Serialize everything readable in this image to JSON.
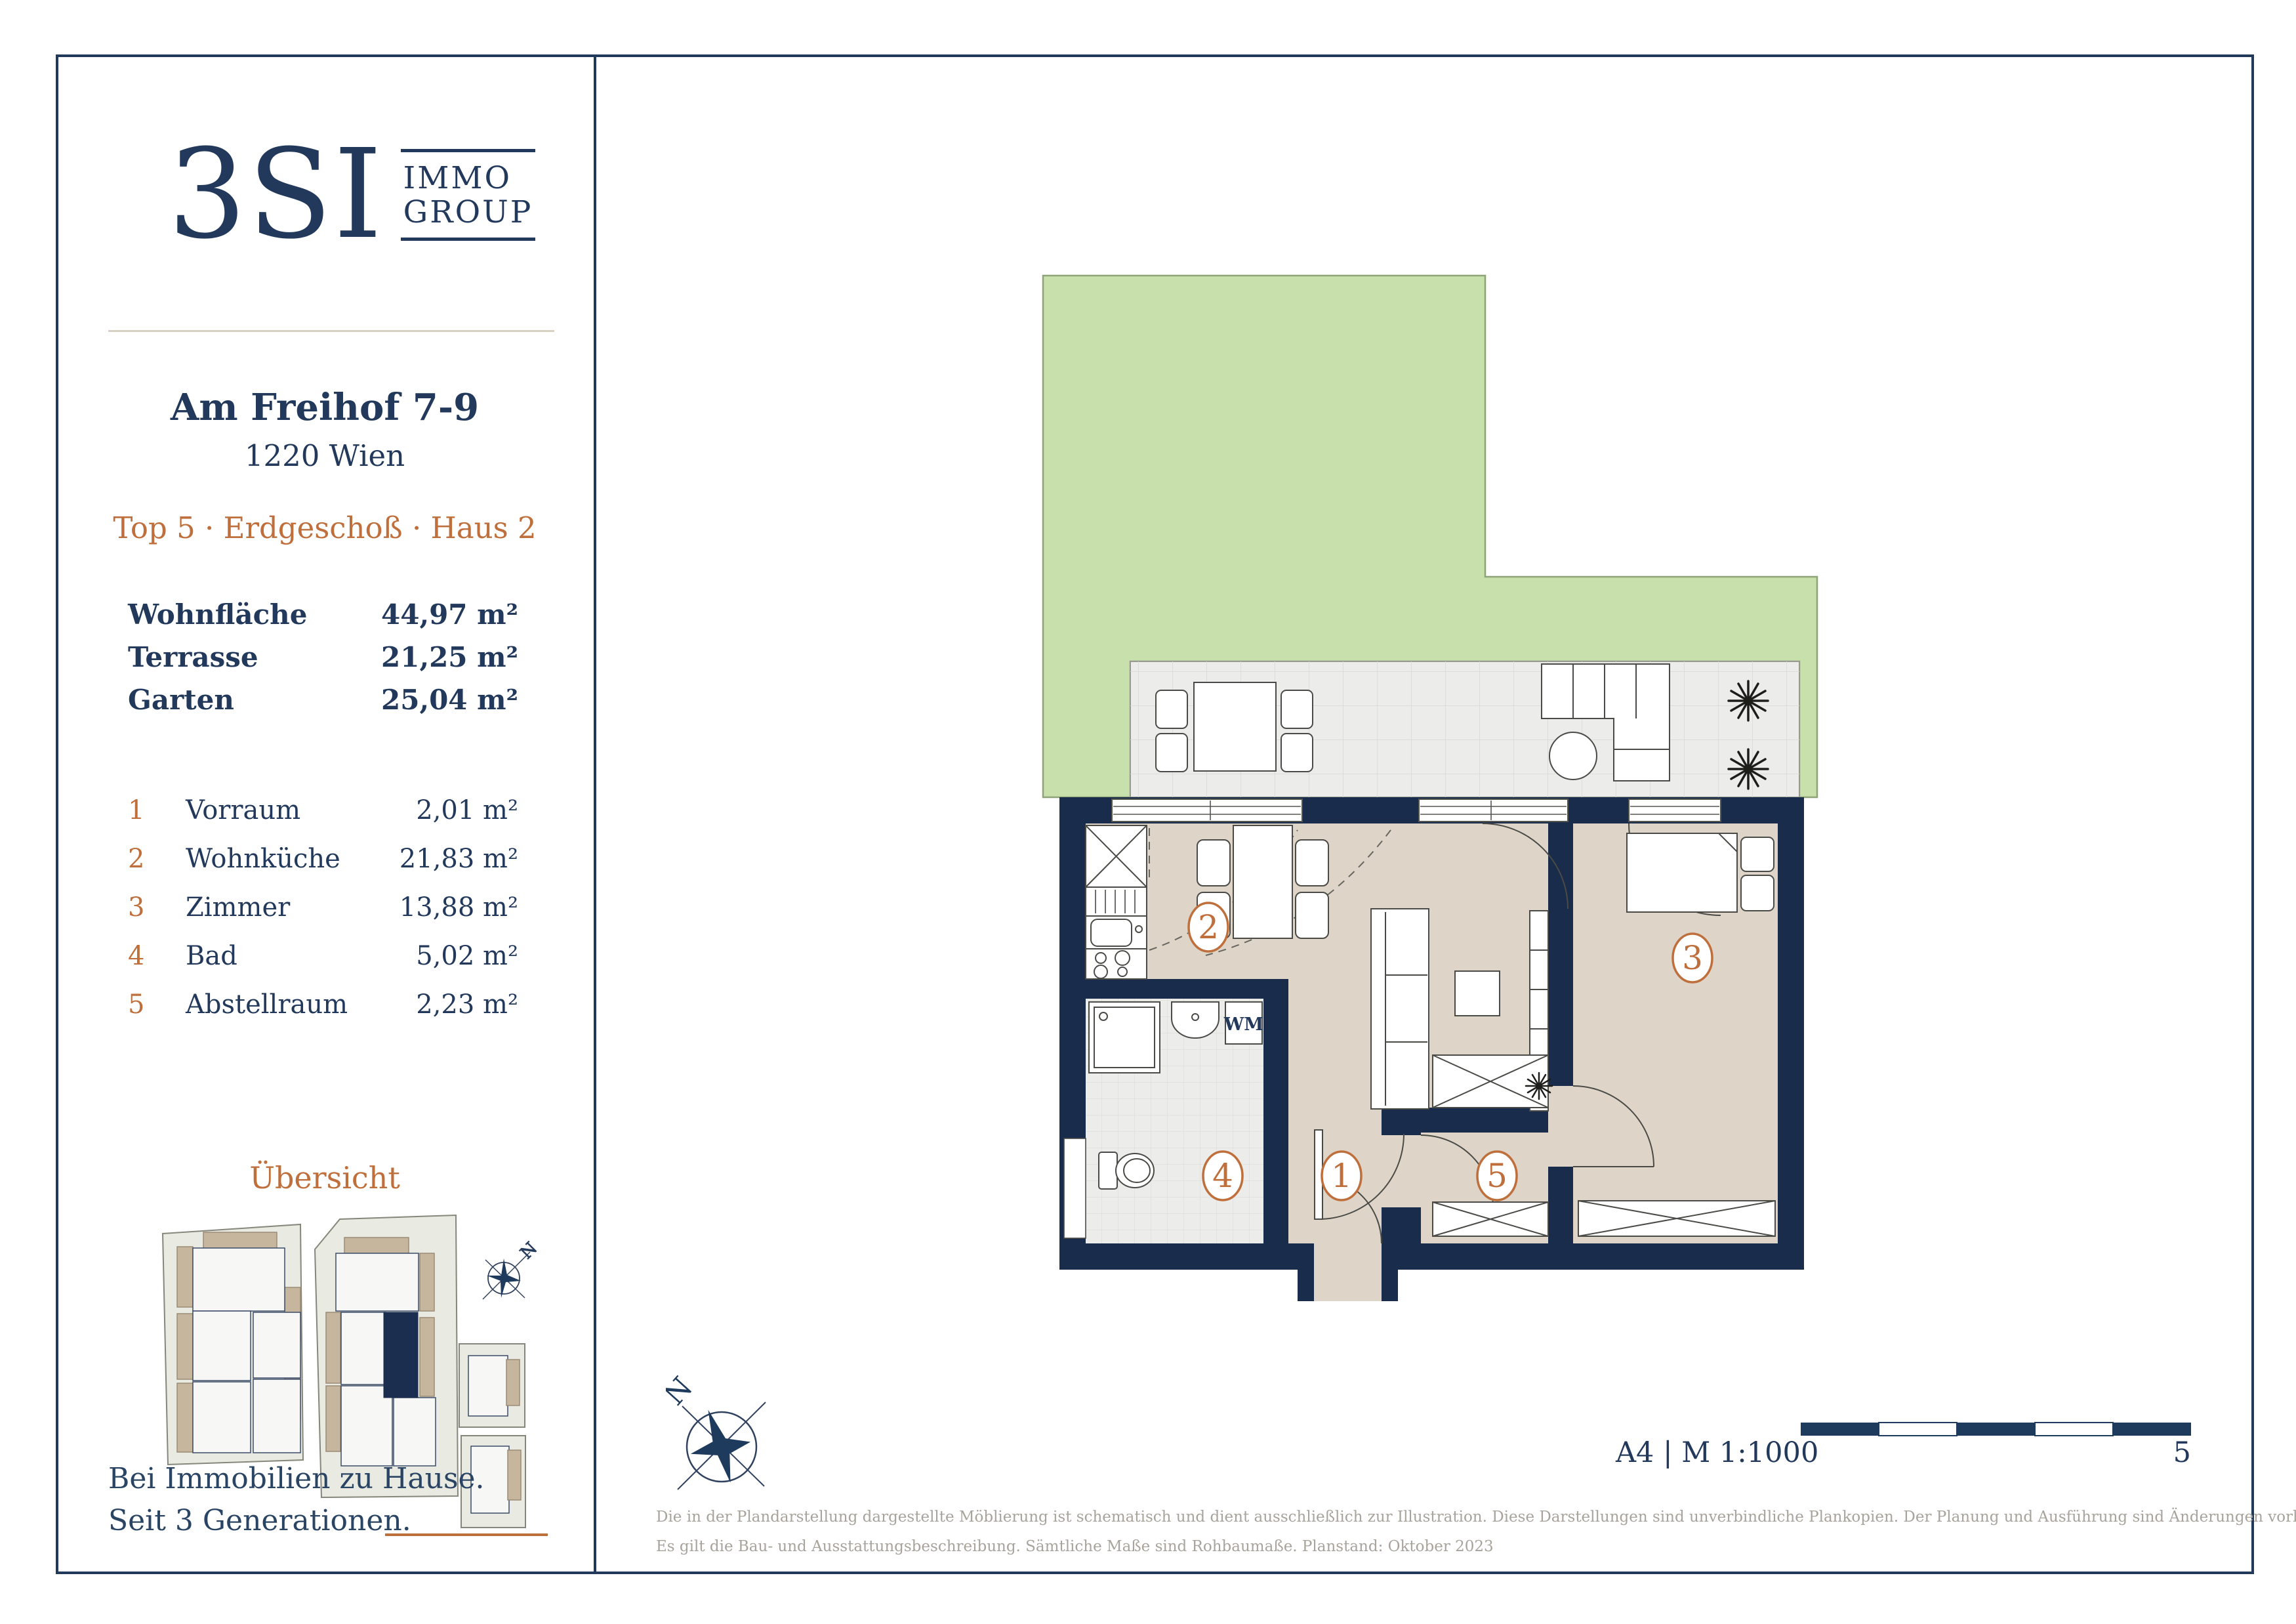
{
  "colors": {
    "navy_text": "#22395c",
    "wall_navy": "#1a2c4b",
    "accent_orange": "#bf6f3c",
    "floor_beige": "#ded5c8",
    "tile_gray": "#ececea",
    "garden_green": "#c8e1ac",
    "disclaimer_gray": "#a8a39b",
    "site_parcel": "#e9ebe2",
    "site_tan": "#c6b69e",
    "unit_highlight": "#1c2e4f"
  },
  "sidebar": {
    "logo": {
      "mark": "3SI",
      "immo": "IMMO",
      "group": "GROUP"
    },
    "address_line1": "Am Freihof 7-9",
    "address_line2": "1220 Wien",
    "unit_line": "Top 5 · Erdgeschoß · Haus 2",
    "areas": [
      {
        "label": "Wohnfläche",
        "value": "44,97 m²"
      },
      {
        "label": "Terrasse",
        "value": "21,25 m²"
      },
      {
        "label": "Garten",
        "value": "25,04 m²"
      }
    ],
    "rooms": [
      {
        "num": "1",
        "label": "Vorraum",
        "value": "2,01 m²"
      },
      {
        "num": "2",
        "label": "Wohnküche",
        "value": "21,83 m²"
      },
      {
        "num": "3",
        "label": "Zimmer",
        "value": "13,88 m²"
      },
      {
        "num": "4",
        "label": "Bad",
        "value": "5,02 m²"
      },
      {
        "num": "5",
        "label": "Abstellraum",
        "value": "2,23 m²"
      }
    ],
    "overview_title": "Übersicht",
    "tagline_line1": "Bei Immobilien zu Hause.",
    "tagline_line2": "Seit 3 Generationen."
  },
  "plan": {
    "wm_label": "WM",
    "compass_letter": "N",
    "site_compass_letter": "N",
    "room_labels": [
      "1",
      "2",
      "3",
      "4",
      "5"
    ]
  },
  "footer": {
    "format_scale": "A4 | M 1:100",
    "scale_zero": "0",
    "scale_five": "5",
    "disclaimer_line1": "Die in der Plandarstellung dargestellte Möblierung ist schematisch und dient ausschließlich zur Illustration. Diese Darstellungen sind unverbindliche Plankopien. Der Planung und Ausführung sind Änderungen vorbehalten.",
    "disclaimer_line2": "Es gilt die Bau- und Ausstattungsbeschreibung. Sämtliche Maße sind Rohbaumaße. Planstand: Oktober 2023"
  }
}
